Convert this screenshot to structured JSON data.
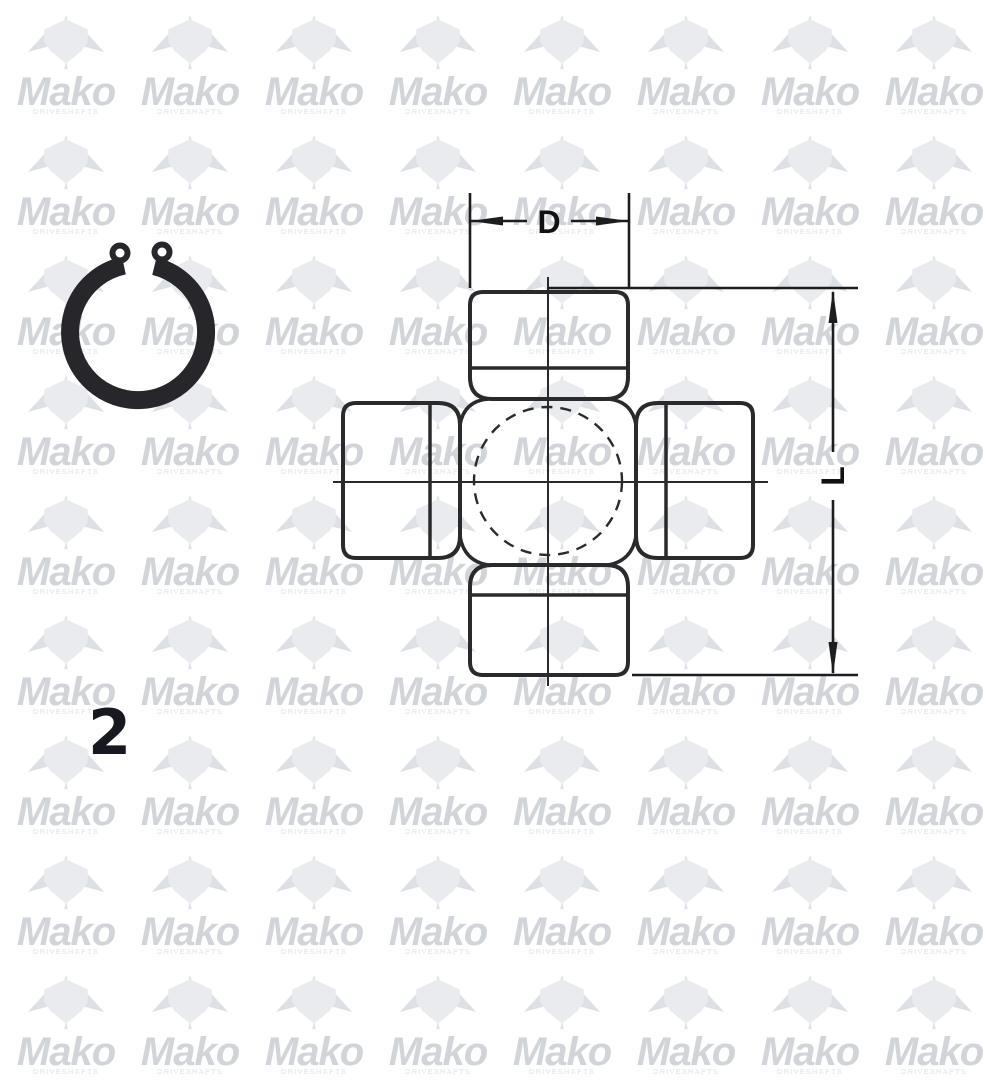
{
  "page": {
    "background": "#ffffff"
  },
  "watermark": {
    "brand": "Mako",
    "subtitle": "DRIVESHAFTS",
    "brand_color": "#d1d4d8",
    "subtitle_color": "#e8ebef",
    "icon": "mako-shark-icon",
    "icon_body_color": "#e9ebef",
    "icon_fin_color": "#dde0e5",
    "columns": 8,
    "rows": 9,
    "tile_width": 124,
    "tile_height": 120,
    "offset_x": 4,
    "offset_y": 12
  },
  "figure": {
    "type": "technical-drawing",
    "subject": "universal-joint-cross-with-bearing-caps",
    "line_color": "#2a2a2c",
    "dim_d_label": "D",
    "dim_l_label": "L",
    "dim_d_meaning": "cap-diameter-horizontal",
    "dim_l_meaning": "overall-length-vertical"
  },
  "snap_ring": {
    "shape": "internal-circlip-with-eyelets",
    "color": "#26262b"
  },
  "part_index": {
    "value": "2",
    "color": "#181821"
  }
}
